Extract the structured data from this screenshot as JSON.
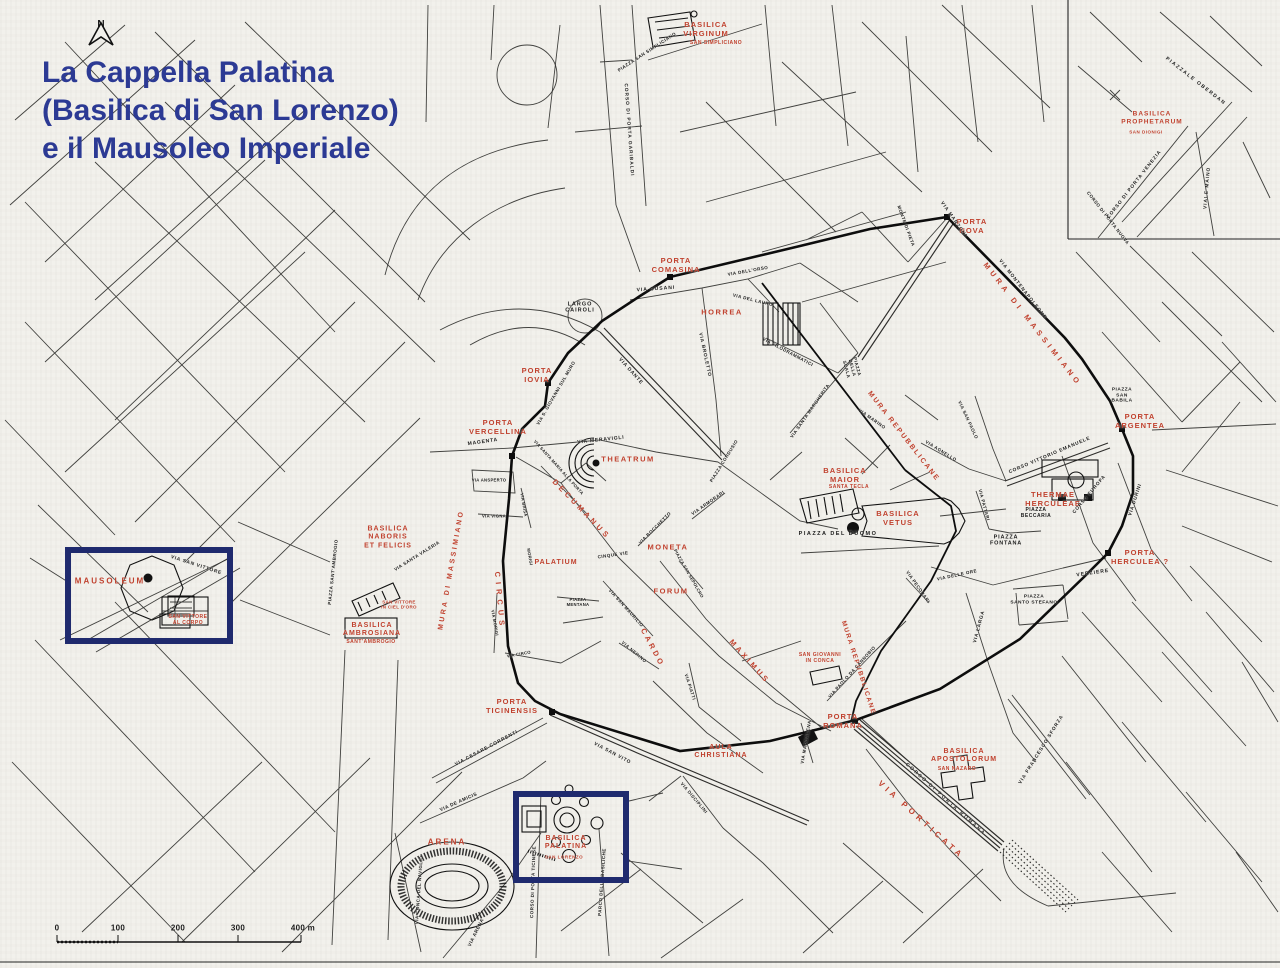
{
  "title": {
    "lines": [
      "La Cappella Palatina",
      "(Basilica di San Lorenzo)",
      "e il Mausoleo Imperiale"
    ]
  },
  "compass": {
    "label": "N"
  },
  "scale_bar": {
    "unit_labels": [
      "0",
      "100",
      "200",
      "300",
      "400 m"
    ]
  },
  "colors": {
    "title_blue": "#2c3a94",
    "feature_red": "#c0412e",
    "street_black": "#1b1b1b",
    "highlight_navy": "#1f2a6e",
    "paper": "#f2f1ec"
  },
  "highlight_boxes": [
    {
      "name": "mausoleum-box",
      "around": "MAUSOLEUM"
    },
    {
      "name": "cappella-palatina-box",
      "around": "BASILICA PALATINA SAN LORENZO"
    }
  ],
  "labels": {
    "features": [
      {
        "t": "BASILICA\nVIRGINUM",
        "x": 706,
        "y": 30,
        "s": 7.5,
        "ls": 1
      },
      {
        "t": "SAN SIMPLICIANO",
        "x": 716,
        "y": 44,
        "s": 5,
        "ls": 0.5
      },
      {
        "t": "PORTA\nCOMASINA",
        "x": 676,
        "y": 266,
        "s": 7.5,
        "ls": 1
      },
      {
        "t": "PORTA\nNOVA",
        "x": 972,
        "y": 227,
        "s": 7.5,
        "ls": 1
      },
      {
        "t": "MURA DI MASSIMIANO",
        "x": 1032,
        "y": 325,
        "r": 52,
        "s": 7.5,
        "ls": 4
      },
      {
        "t": "MURA DI MASSIMIANO",
        "x": 452,
        "y": 570,
        "r": -80,
        "s": 7,
        "ls": 2.5
      },
      {
        "t": "HORREA",
        "x": 722,
        "y": 313,
        "s": 7.5,
        "ls": 1.5
      },
      {
        "t": "PORTA\nIOVIA",
        "x": 537,
        "y": 376,
        "s": 7.5,
        "ls": 1
      },
      {
        "t": "PORTA\nVERCELLINA",
        "x": 498,
        "y": 428,
        "s": 7.5,
        "ls": 1
      },
      {
        "t": "THEATRUM",
        "x": 628,
        "y": 460,
        "s": 7.5,
        "ls": 1.5
      },
      {
        "t": "DECUMANUS",
        "x": 581,
        "y": 510,
        "r": 46,
        "s": 7.5,
        "ls": 3.5
      },
      {
        "t": "MONETA",
        "x": 668,
        "y": 548,
        "s": 7.5,
        "ls": 1.5
      },
      {
        "t": "PALATIUM",
        "x": 556,
        "y": 563,
        "s": 7,
        "ls": 1
      },
      {
        "t": "FORUM",
        "x": 671,
        "y": 592,
        "s": 7.5,
        "ls": 1.5
      },
      {
        "t": "CARDO",
        "x": 652,
        "y": 648,
        "r": 62,
        "s": 7.5,
        "ls": 3
      },
      {
        "t": "MAXIMUS",
        "x": 749,
        "y": 662,
        "r": 48,
        "s": 7.5,
        "ls": 3
      },
      {
        "t": "BASILICA\nMAIOR",
        "x": 845,
        "y": 476,
        "s": 7.5,
        "ls": 1
      },
      {
        "t": "SANTA TECLA",
        "x": 849,
        "y": 488,
        "s": 5,
        "ls": 0.5
      },
      {
        "t": "BASILICA\nVETUS",
        "x": 898,
        "y": 519,
        "s": 7.5,
        "ls": 1
      },
      {
        "t": "MURA REPUBBLICANE",
        "x": 903,
        "y": 437,
        "r": 52,
        "s": 7,
        "ls": 2
      },
      {
        "t": "MURA REPUBBLICANE",
        "x": 858,
        "y": 668,
        "r": 72,
        "s": 6.5,
        "ls": 1.5
      },
      {
        "t": "SAN GIOVANNI\nIN CONCA",
        "x": 820,
        "y": 659,
        "s": 5,
        "ls": 0.5
      },
      {
        "t": "THERMAE\nHERCULEAE",
        "x": 1053,
        "y": 500,
        "s": 7.5,
        "ls": 1
      },
      {
        "t": "PORTA\nARGENTEA",
        "x": 1140,
        "y": 422,
        "s": 7.5,
        "ls": 1
      },
      {
        "t": "PORTA\nHERCULEA ?",
        "x": 1140,
        "y": 558,
        "s": 7.5,
        "ls": 1
      },
      {
        "t": "BASILICA\nPROPHETARUM",
        "x": 1152,
        "y": 118,
        "s": 6.5,
        "ls": 1
      },
      {
        "t": "SAN DIONIGI",
        "x": 1146,
        "y": 132,
        "s": 4.5,
        "ls": 0.5
      },
      {
        "t": "MAUSOLEUM",
        "x": 110,
        "y": 581,
        "s": 8,
        "ls": 2
      },
      {
        "t": "SAN VITTORE\nAL CORPO",
        "x": 188,
        "y": 621,
        "s": 5,
        "ls": 0.5
      },
      {
        "t": "BASILICA\nNABORIS\nET FELICIS",
        "x": 388,
        "y": 538,
        "s": 7,
        "ls": 1
      },
      {
        "t": "SAN VITTORE\nIN CIEL D'ORO",
        "x": 399,
        "y": 605,
        "s": 4.5,
        "ls": 0.3
      },
      {
        "t": "BASILICA\nAMBROSIANA",
        "x": 372,
        "y": 630,
        "s": 7,
        "ls": 1
      },
      {
        "t": "SANT'AMBROGIO",
        "x": 371,
        "y": 643,
        "s": 5,
        "ls": 0.5
      },
      {
        "t": "CIRCUS",
        "x": 499,
        "y": 601,
        "r": 85,
        "s": 7.5,
        "ls": 5
      },
      {
        "t": "PORTA\nTICINENSIS",
        "x": 512,
        "y": 707,
        "s": 7.5,
        "ls": 1
      },
      {
        "t": "AULA\nCHRISTIANA",
        "x": 721,
        "y": 752,
        "s": 7,
        "ls": 1
      },
      {
        "t": "PORTA\nROMANA",
        "x": 843,
        "y": 722,
        "s": 7.5,
        "ls": 1
      },
      {
        "t": "VIA PORTICATA",
        "x": 921,
        "y": 820,
        "r": 42,
        "s": 8,
        "ls": 4
      },
      {
        "t": "BASILICA\nAPOSTOLORUM",
        "x": 964,
        "y": 756,
        "s": 7,
        "ls": 1
      },
      {
        "t": "SAN NAZARO",
        "x": 957,
        "y": 770,
        "s": 5,
        "ls": 0.5
      },
      {
        "t": "ARENA",
        "x": 447,
        "y": 842,
        "s": 8,
        "ls": 2
      },
      {
        "t": "BASILICA\nPALATINA",
        "x": 566,
        "y": 843,
        "s": 7,
        "ls": 1
      },
      {
        "t": "SAN LORENZO",
        "x": 564,
        "y": 857,
        "s": 4.5,
        "ls": 0.5
      }
    ],
    "streets": [
      {
        "t": "PIAZZA SAN SIMPLICIANO",
        "x": 647,
        "y": 52,
        "r": -33,
        "s": 4.5,
        "ls": 0.5
      },
      {
        "t": "CORSO DI PORTA GARIBALDI",
        "x": 628,
        "y": 130,
        "r": 86,
        "s": 4.8,
        "ls": 1
      },
      {
        "t": "LARGO\nCAIROLI",
        "x": 580,
        "y": 308,
        "s": 5.5,
        "ls": 1
      },
      {
        "t": "VIA CUSANI",
        "x": 656,
        "y": 290,
        "r": -4,
        "s": 5,
        "ls": 1
      },
      {
        "t": "VIA DELL'ORSO",
        "x": 748,
        "y": 271,
        "r": -10,
        "s": 4.5,
        "ls": 0.5
      },
      {
        "t": "VIA DEL LAURO",
        "x": 753,
        "y": 300,
        "r": 14,
        "s": 4.5,
        "ls": 0.5
      },
      {
        "t": "MONTE DI PIETA",
        "x": 906,
        "y": 226,
        "r": 70,
        "s": 4.5,
        "ls": 0.5
      },
      {
        "t": "VIA MANZONI",
        "x": 953,
        "y": 220,
        "r": 55,
        "s": 4.8,
        "ls": 1
      },
      {
        "t": "VIA MONTENAPOLEONE",
        "x": 1022,
        "y": 290,
        "r": 52,
        "s": 4.8,
        "ls": 1
      },
      {
        "t": "CORSO DI PORTA NUOVA",
        "x": 1108,
        "y": 218,
        "r": 52,
        "s": 4.5,
        "ls": 0.5
      },
      {
        "t": "PIAZZALE OBERDAN",
        "x": 1195,
        "y": 82,
        "r": 38,
        "s": 5,
        "ls": 1.5
      },
      {
        "t": "CORSO DI PORTA VENEZIA",
        "x": 1135,
        "y": 185,
        "r": -52,
        "s": 4.8,
        "ls": 1
      },
      {
        "t": "VIALE MAINO",
        "x": 1208,
        "y": 188,
        "r": -85,
        "s": 4.8,
        "ls": 1
      },
      {
        "t": "VIA FILODRAMMATICI",
        "x": 788,
        "y": 352,
        "r": 28,
        "s": 4.5,
        "ls": 0.5
      },
      {
        "t": "PIAZZA\nDELLA\nSCALA",
        "x": 852,
        "y": 368,
        "r": 75,
        "s": 4.5,
        "ls": 0.5
      },
      {
        "t": "VIA SANTA MARGHERITA",
        "x": 810,
        "y": 411,
        "r": -55,
        "s": 4.5,
        "ls": 0.5
      },
      {
        "t": "VIA MARINO",
        "x": 872,
        "y": 419,
        "r": 35,
        "s": 4.5,
        "ls": 0.5
      },
      {
        "t": "VIA SAN PAOLO",
        "x": 968,
        "y": 420,
        "r": 65,
        "s": 4.5,
        "ls": 0.5
      },
      {
        "t": "CORSO VITTORIO EMANUELE",
        "x": 1050,
        "y": 456,
        "r": -23,
        "s": 4.8,
        "ls": 0.8
      },
      {
        "t": "PIAZZA\nSAN\nBABILA",
        "x": 1122,
        "y": 396,
        "s": 4.8,
        "ls": 0.5
      },
      {
        "t": "VIA AGNELLO",
        "x": 941,
        "y": 451,
        "r": 32,
        "s": 4.5,
        "ls": 0.5
      },
      {
        "t": "VIA PATTARI",
        "x": 984,
        "y": 505,
        "r": 75,
        "s": 4.5,
        "ls": 0.5
      },
      {
        "t": "PIAZZA\nBECCARIA",
        "x": 1036,
        "y": 514,
        "s": 5,
        "ls": 0.5
      },
      {
        "t": "PIAZZA\nFONTANA",
        "x": 1006,
        "y": 541,
        "s": 5.5,
        "ls": 0.8
      },
      {
        "t": "PIAZZA DEL DUOMO",
        "x": 838,
        "y": 534,
        "s": 5.5,
        "ls": 1.5
      },
      {
        "t": "VIA DELLE ORE",
        "x": 957,
        "y": 575,
        "r": -12,
        "s": 4.5,
        "ls": 0.5
      },
      {
        "t": "VIA PECORARI",
        "x": 918,
        "y": 587,
        "r": 55,
        "s": 4.5,
        "ls": 0.5
      },
      {
        "t": "VERZIERE",
        "x": 1093,
        "y": 574,
        "r": -8,
        "s": 5,
        "ls": 1
      },
      {
        "t": "CORSO EUROPA",
        "x": 1090,
        "y": 495,
        "r": -50,
        "s": 4.8,
        "ls": 0.8
      },
      {
        "t": "VIA DURINI",
        "x": 1136,
        "y": 500,
        "r": -72,
        "s": 4.8,
        "ls": 0.8
      },
      {
        "t": "PIAZZA\nSANTO STEFANO",
        "x": 1034,
        "y": 600,
        "s": 4.8,
        "ls": 0.5
      },
      {
        "t": "VIA LARGA",
        "x": 980,
        "y": 627,
        "r": -75,
        "s": 4.8,
        "ls": 0.8
      },
      {
        "t": "VIA FRANCESCO SFORZA",
        "x": 1042,
        "y": 750,
        "r": -58,
        "s": 4.8,
        "ls": 1
      },
      {
        "t": "CORSO DI PORTA ROMANA",
        "x": 945,
        "y": 800,
        "r": 42,
        "s": 4.8,
        "ls": 2
      },
      {
        "t": "VIA MADDALENA",
        "x": 806,
        "y": 742,
        "r": -80,
        "s": 4.5,
        "ls": 0.5
      },
      {
        "t": "VIA PAOLO DA CANNOBIO",
        "x": 852,
        "y": 672,
        "r": -48,
        "s": 4.5,
        "ls": 0.5
      },
      {
        "t": "VIA SAN MAURILIO",
        "x": 626,
        "y": 608,
        "r": 48,
        "s": 4.5,
        "ls": 0.5
      },
      {
        "t": "VIA NERINO",
        "x": 634,
        "y": 652,
        "r": 40,
        "s": 4.5,
        "ls": 0.5
      },
      {
        "t": "CINQUE VIE",
        "x": 613,
        "y": 555,
        "r": -8,
        "s": 4.5,
        "ls": 0.5
      },
      {
        "t": "VIA BOCCHETTO",
        "x": 655,
        "y": 528,
        "r": -45,
        "s": 4.5,
        "ls": 0.5
      },
      {
        "t": "VIA ARMORARI",
        "x": 708,
        "y": 503,
        "r": -35,
        "s": 4.5,
        "ls": 0.5
      },
      {
        "t": "PIAZZA SAN SEPOLCRO",
        "x": 688,
        "y": 574,
        "r": 60,
        "s": 4.2,
        "ls": 0.3
      },
      {
        "t": "PIAZZA CORDUSIO",
        "x": 724,
        "y": 461,
        "r": -58,
        "s": 4.5,
        "ls": 0.5
      },
      {
        "t": "VIA MERAVIGLI",
        "x": 601,
        "y": 441,
        "r": -6,
        "s": 5,
        "ls": 0.8
      },
      {
        "t": "MAGENTA",
        "x": 483,
        "y": 443,
        "r": -8,
        "s": 5,
        "ls": 0.8
      },
      {
        "t": "VIA S. GIOVANNI SUL MURO",
        "x": 556,
        "y": 393,
        "r": -60,
        "s": 4.5,
        "ls": 0.5
      },
      {
        "t": "VIA DANTE",
        "x": 630,
        "y": 372,
        "r": 48,
        "s": 5,
        "ls": 0.8
      },
      {
        "t": "VIA BROLETTO",
        "x": 704,
        "y": 355,
        "r": 78,
        "s": 4.8,
        "ls": 0.8
      },
      {
        "t": "VIA ANSPERTO",
        "x": 489,
        "y": 481,
        "s": 4.2,
        "ls": 0.3
      },
      {
        "t": "VIA VIGNA",
        "x": 494,
        "y": 517,
        "s": 4.2,
        "ls": 0.3
      },
      {
        "t": "VIA BRISA",
        "x": 523,
        "y": 505,
        "r": 80,
        "s": 4.2,
        "ls": 0.3
      },
      {
        "t": "VIA MORIGI",
        "x": 494,
        "y": 623,
        "r": 80,
        "s": 4.2,
        "ls": 0.3
      },
      {
        "t": "MORIGI",
        "x": 529,
        "y": 557,
        "r": 80,
        "s": 4.2,
        "ls": 0.3
      },
      {
        "t": "VIA CIRCO",
        "x": 519,
        "y": 655,
        "r": -10,
        "s": 4.2,
        "ls": 0.3
      },
      {
        "t": "VIA SANTA MARIA ALLA PORTA",
        "x": 558,
        "y": 468,
        "r": 48,
        "s": 4.2,
        "ls": 0.3
      },
      {
        "t": "VIA SANTA VALERIA",
        "x": 417,
        "y": 556,
        "r": -32,
        "s": 4.5,
        "ls": 0.5
      },
      {
        "t": "PIAZZA SANT'AMBROGIO",
        "x": 333,
        "y": 572,
        "r": -84,
        "s": 4.5,
        "ls": 0.5
      },
      {
        "t": "VIA SAN VITTORE",
        "x": 196,
        "y": 566,
        "r": 18,
        "s": 4.8,
        "ls": 0.8
      },
      {
        "t": "PIAZZA\nMENTANA",
        "x": 578,
        "y": 603,
        "s": 4.2,
        "ls": 0.3
      },
      {
        "t": "VIA CESARE CORRENTI",
        "x": 487,
        "y": 749,
        "r": -28,
        "s": 4.8,
        "ls": 0.8
      },
      {
        "t": "VIA SAN VITO",
        "x": 612,
        "y": 754,
        "r": 28,
        "s": 4.8,
        "ls": 0.8
      },
      {
        "t": "VIA DISCIPLINI",
        "x": 694,
        "y": 798,
        "r": 50,
        "s": 4.5,
        "ls": 0.5
      },
      {
        "t": "VIA PIATTI",
        "x": 690,
        "y": 687,
        "r": 72,
        "s": 4.5,
        "ls": 0.5
      },
      {
        "t": "VIA DE AMICIS",
        "x": 459,
        "y": 803,
        "r": -24,
        "s": 4.8,
        "ls": 0.5
      },
      {
        "t": "VIA ARENA",
        "x": 477,
        "y": 933,
        "r": -64,
        "s": 4.8,
        "ls": 0.5
      },
      {
        "t": "VIA CONCA DEL NAVIGLIO",
        "x": 419,
        "y": 890,
        "r": -86,
        "s": 4.5,
        "ls": 0.5
      },
      {
        "t": "CORSO DI PORTA TICINESE",
        "x": 533,
        "y": 882,
        "r": -88,
        "s": 4.5,
        "ls": 0.5
      },
      {
        "t": "PARCO DELLE BASILICHE",
        "x": 602,
        "y": 882,
        "r": -86,
        "s": 4.5,
        "ls": 0.5
      }
    ]
  }
}
